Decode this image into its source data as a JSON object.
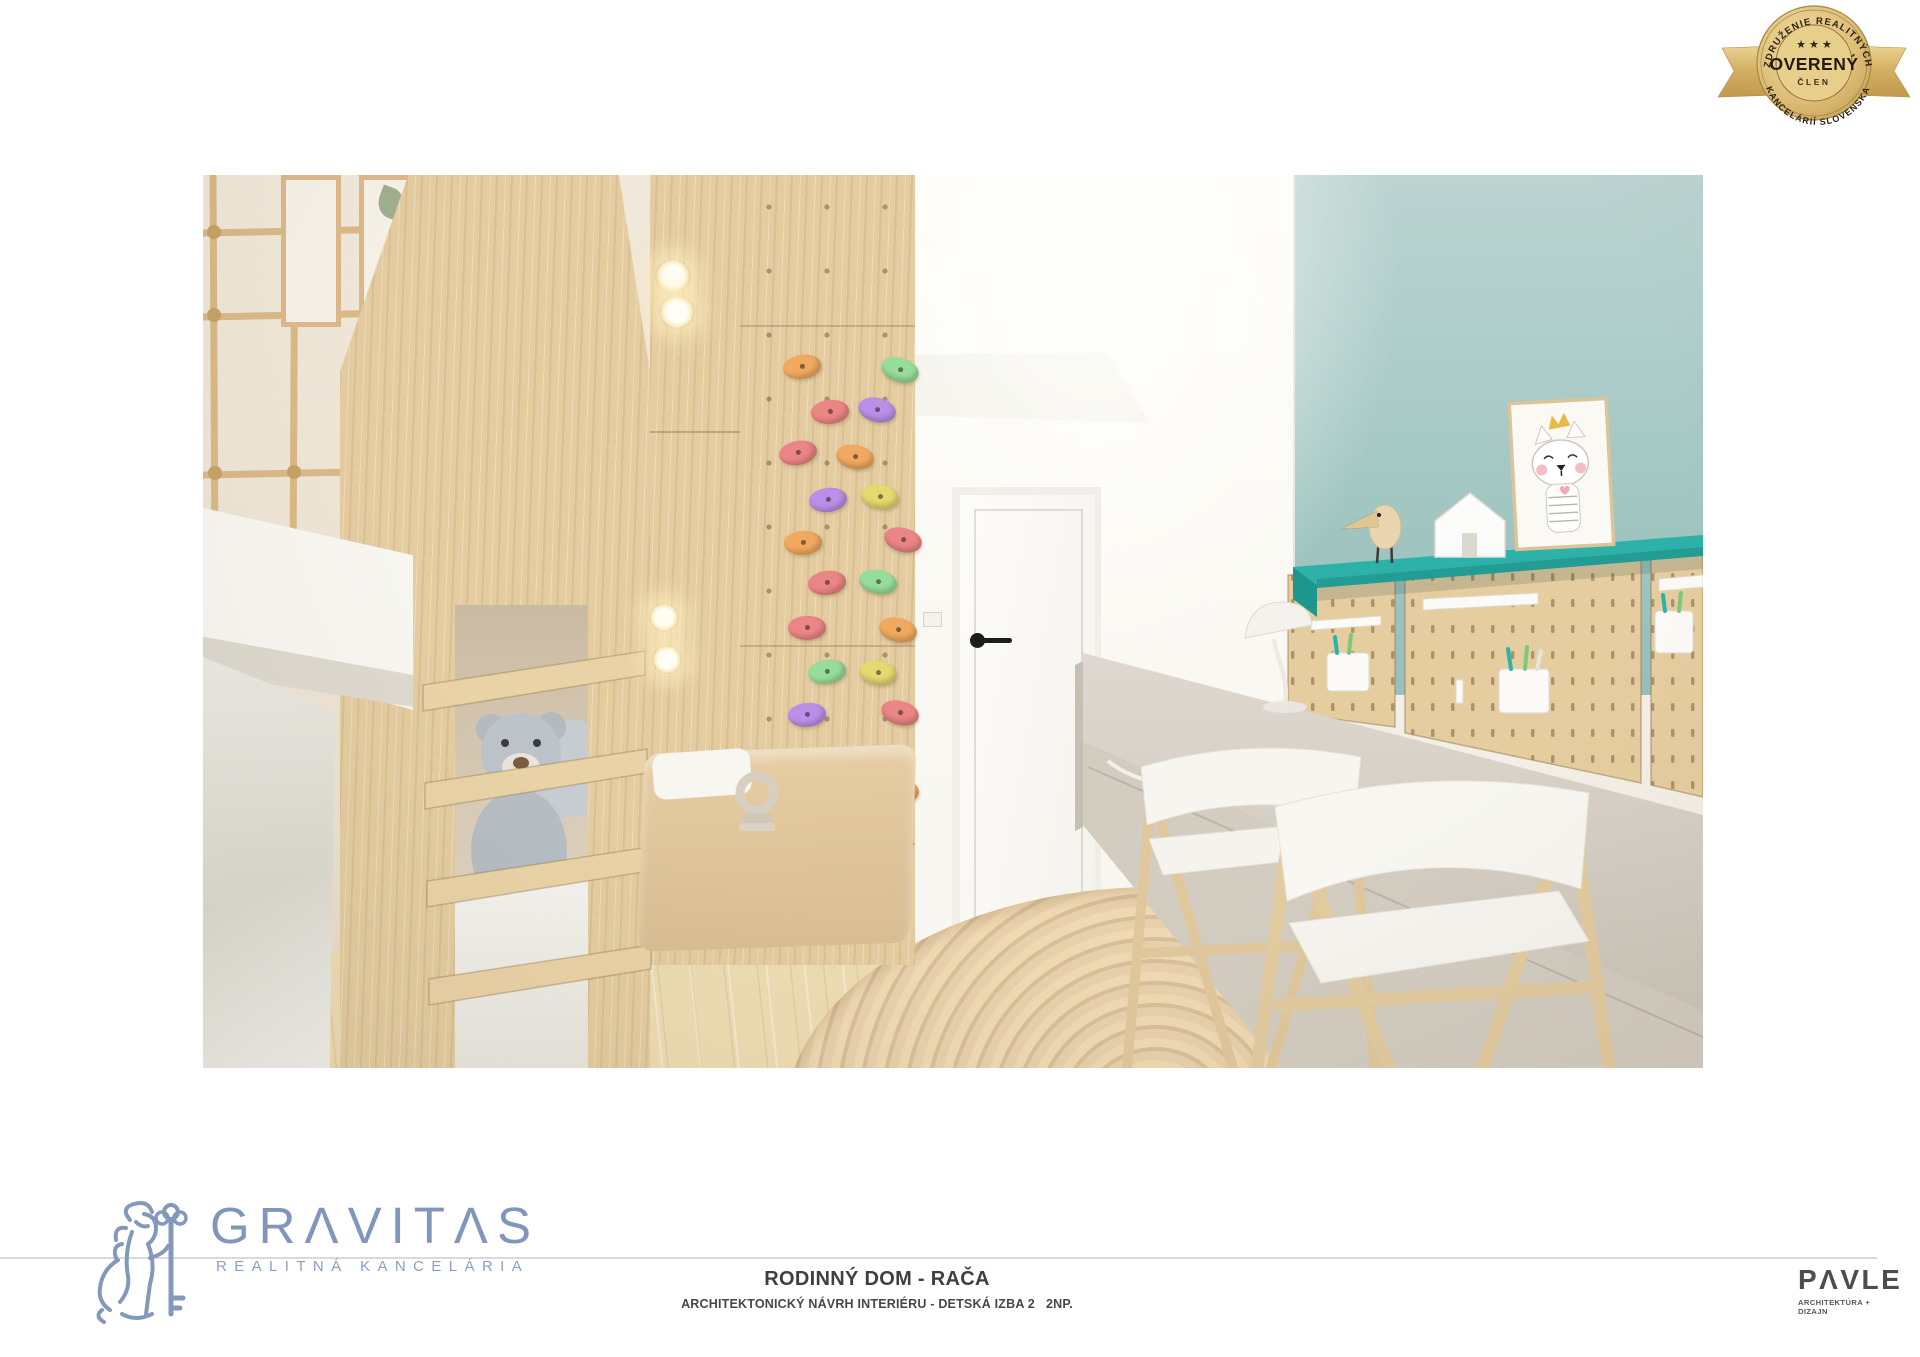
{
  "page": {
    "width": 1920,
    "height": 1357,
    "background": "#ffffff"
  },
  "badge": {
    "arc_top": "ZDRUŽENIE REALITNÝCH",
    "arc_bottom": "KANCELÁRIÍ SLOVENSKA",
    "stars": "★ ★ ★",
    "title": "OVERENÝ",
    "subtitle": "ČLEN",
    "colors": {
      "gold": "#d9b96e",
      "gold_dark": "#a8853e",
      "text": "#2b2313"
    }
  },
  "footer": {
    "gravitas": {
      "brand": "GRAVITAS",
      "brand_display": "GRΛVITΛS",
      "tagline": "REALITNÁ KANCELÁRIA",
      "color": "#8398bb"
    },
    "caption": {
      "title": "RODINNÝ DOM - RAČA",
      "subtitle": "ARCHITEKTONICKÝ NÁVRH INTERIÉRU - DETSKÁ IZBA 2   2NP."
    },
    "pavle": {
      "brand": "PAVLE",
      "brand_display": "PΛVLE",
      "tagline": "ARCHITEKTÚRA + DIZAJN",
      "color": "#4d4d4f"
    }
  },
  "render": {
    "subject": "children's room interior render - bunk bed with climbing net, wooden climbing wall, white door, teal wall with desk, pegboards and two chairs",
    "colors": {
      "accent_teal": "#2db1a8",
      "wall_teal": "#a9cac6",
      "wood": "#e4cca0",
      "floor": "#eddcb2"
    },
    "climbing_holds": [
      {
        "x": 599,
        "y": 192,
        "c": "#f0a95f",
        "r": -12
      },
      {
        "x": 697,
        "y": 195,
        "c": "#97dd9a",
        "r": 14
      },
      {
        "x": 627,
        "y": 237,
        "c": "#ec8585",
        "r": -8
      },
      {
        "x": 674,
        "y": 235,
        "c": "#bb8fe8",
        "r": 10
      },
      {
        "x": 595,
        "y": 278,
        "c": "#ec8585",
        "r": -14
      },
      {
        "x": 652,
        "y": 282,
        "c": "#f0a95f",
        "r": 8
      },
      {
        "x": 625,
        "y": 325,
        "c": "#bb8fe8",
        "r": -10
      },
      {
        "x": 677,
        "y": 322,
        "c": "#e3d96f",
        "r": 6
      },
      {
        "x": 600,
        "y": 368,
        "c": "#f0a95f",
        "r": -6
      },
      {
        "x": 700,
        "y": 365,
        "c": "#ec8585",
        "r": 12
      },
      {
        "x": 624,
        "y": 408,
        "c": "#ec8585",
        "r": -10
      },
      {
        "x": 675,
        "y": 407,
        "c": "#97dd9a",
        "r": 8
      },
      {
        "x": 604,
        "y": 453,
        "c": "#ec8585",
        "r": -4
      },
      {
        "x": 695,
        "y": 455,
        "c": "#f0a95f",
        "r": 10
      },
      {
        "x": 624,
        "y": 497,
        "c": "#97dd9a",
        "r": -12
      },
      {
        "x": 675,
        "y": 498,
        "c": "#e3d96f",
        "r": 6
      },
      {
        "x": 604,
        "y": 540,
        "c": "#bb8fe8",
        "r": -8
      },
      {
        "x": 697,
        "y": 538,
        "c": "#ec8585",
        "r": 12
      },
      {
        "x": 625,
        "y": 585,
        "c": "#97dd9a",
        "r": -6
      },
      {
        "x": 697,
        "y": 615,
        "c": "#f0a95f",
        "r": 8
      },
      {
        "x": 640,
        "y": 655,
        "c": "#e3d96f",
        "r": -10
      }
    ]
  }
}
